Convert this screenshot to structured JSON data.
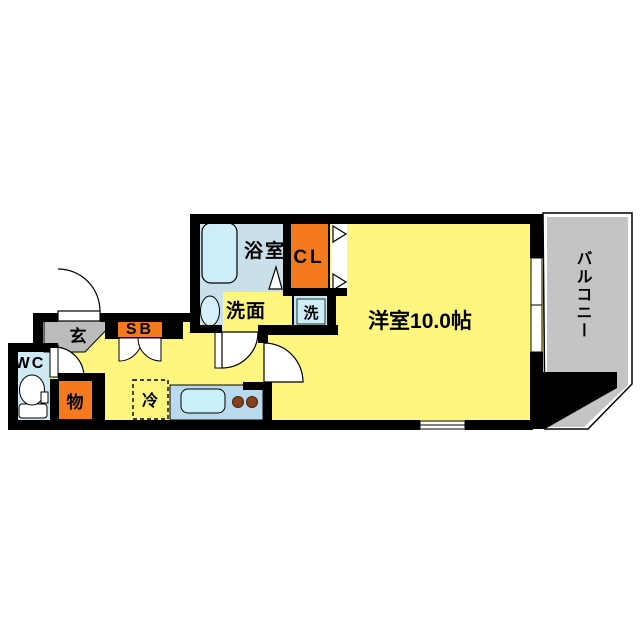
{
  "floor_plan": {
    "type": "apartment-floor-plan",
    "rooms": {
      "main_room": {
        "label": "洋室10.0帖",
        "size_jo": "10.0"
      },
      "balcony": {
        "label": "バルコニー"
      },
      "bathroom": {
        "label": "浴室"
      },
      "closet": {
        "label": "CL"
      },
      "washroom": {
        "label": "洗面"
      },
      "washing_machine": {
        "label": "洗"
      },
      "entrance": {
        "label": "玄"
      },
      "wc": {
        "label": "WC"
      },
      "shoe_box": {
        "label": "SB"
      },
      "storage": {
        "label": "物"
      },
      "refrigerator": {
        "label": "冷"
      }
    },
    "colors": {
      "floor_yellow": "#FFF680",
      "accent_orange": "#F5791D",
      "balcony_gray": "#C4C4C4",
      "entrance_gray": "#BBBBBB",
      "bath_blue": "#C9DFE9",
      "fixture_blue": "#CDEEF8",
      "counter_blue": "#B9DAED",
      "washer_blue": "#C3E8F2",
      "burner_brown": "#83421C",
      "wall_black": "#000000"
    }
  }
}
